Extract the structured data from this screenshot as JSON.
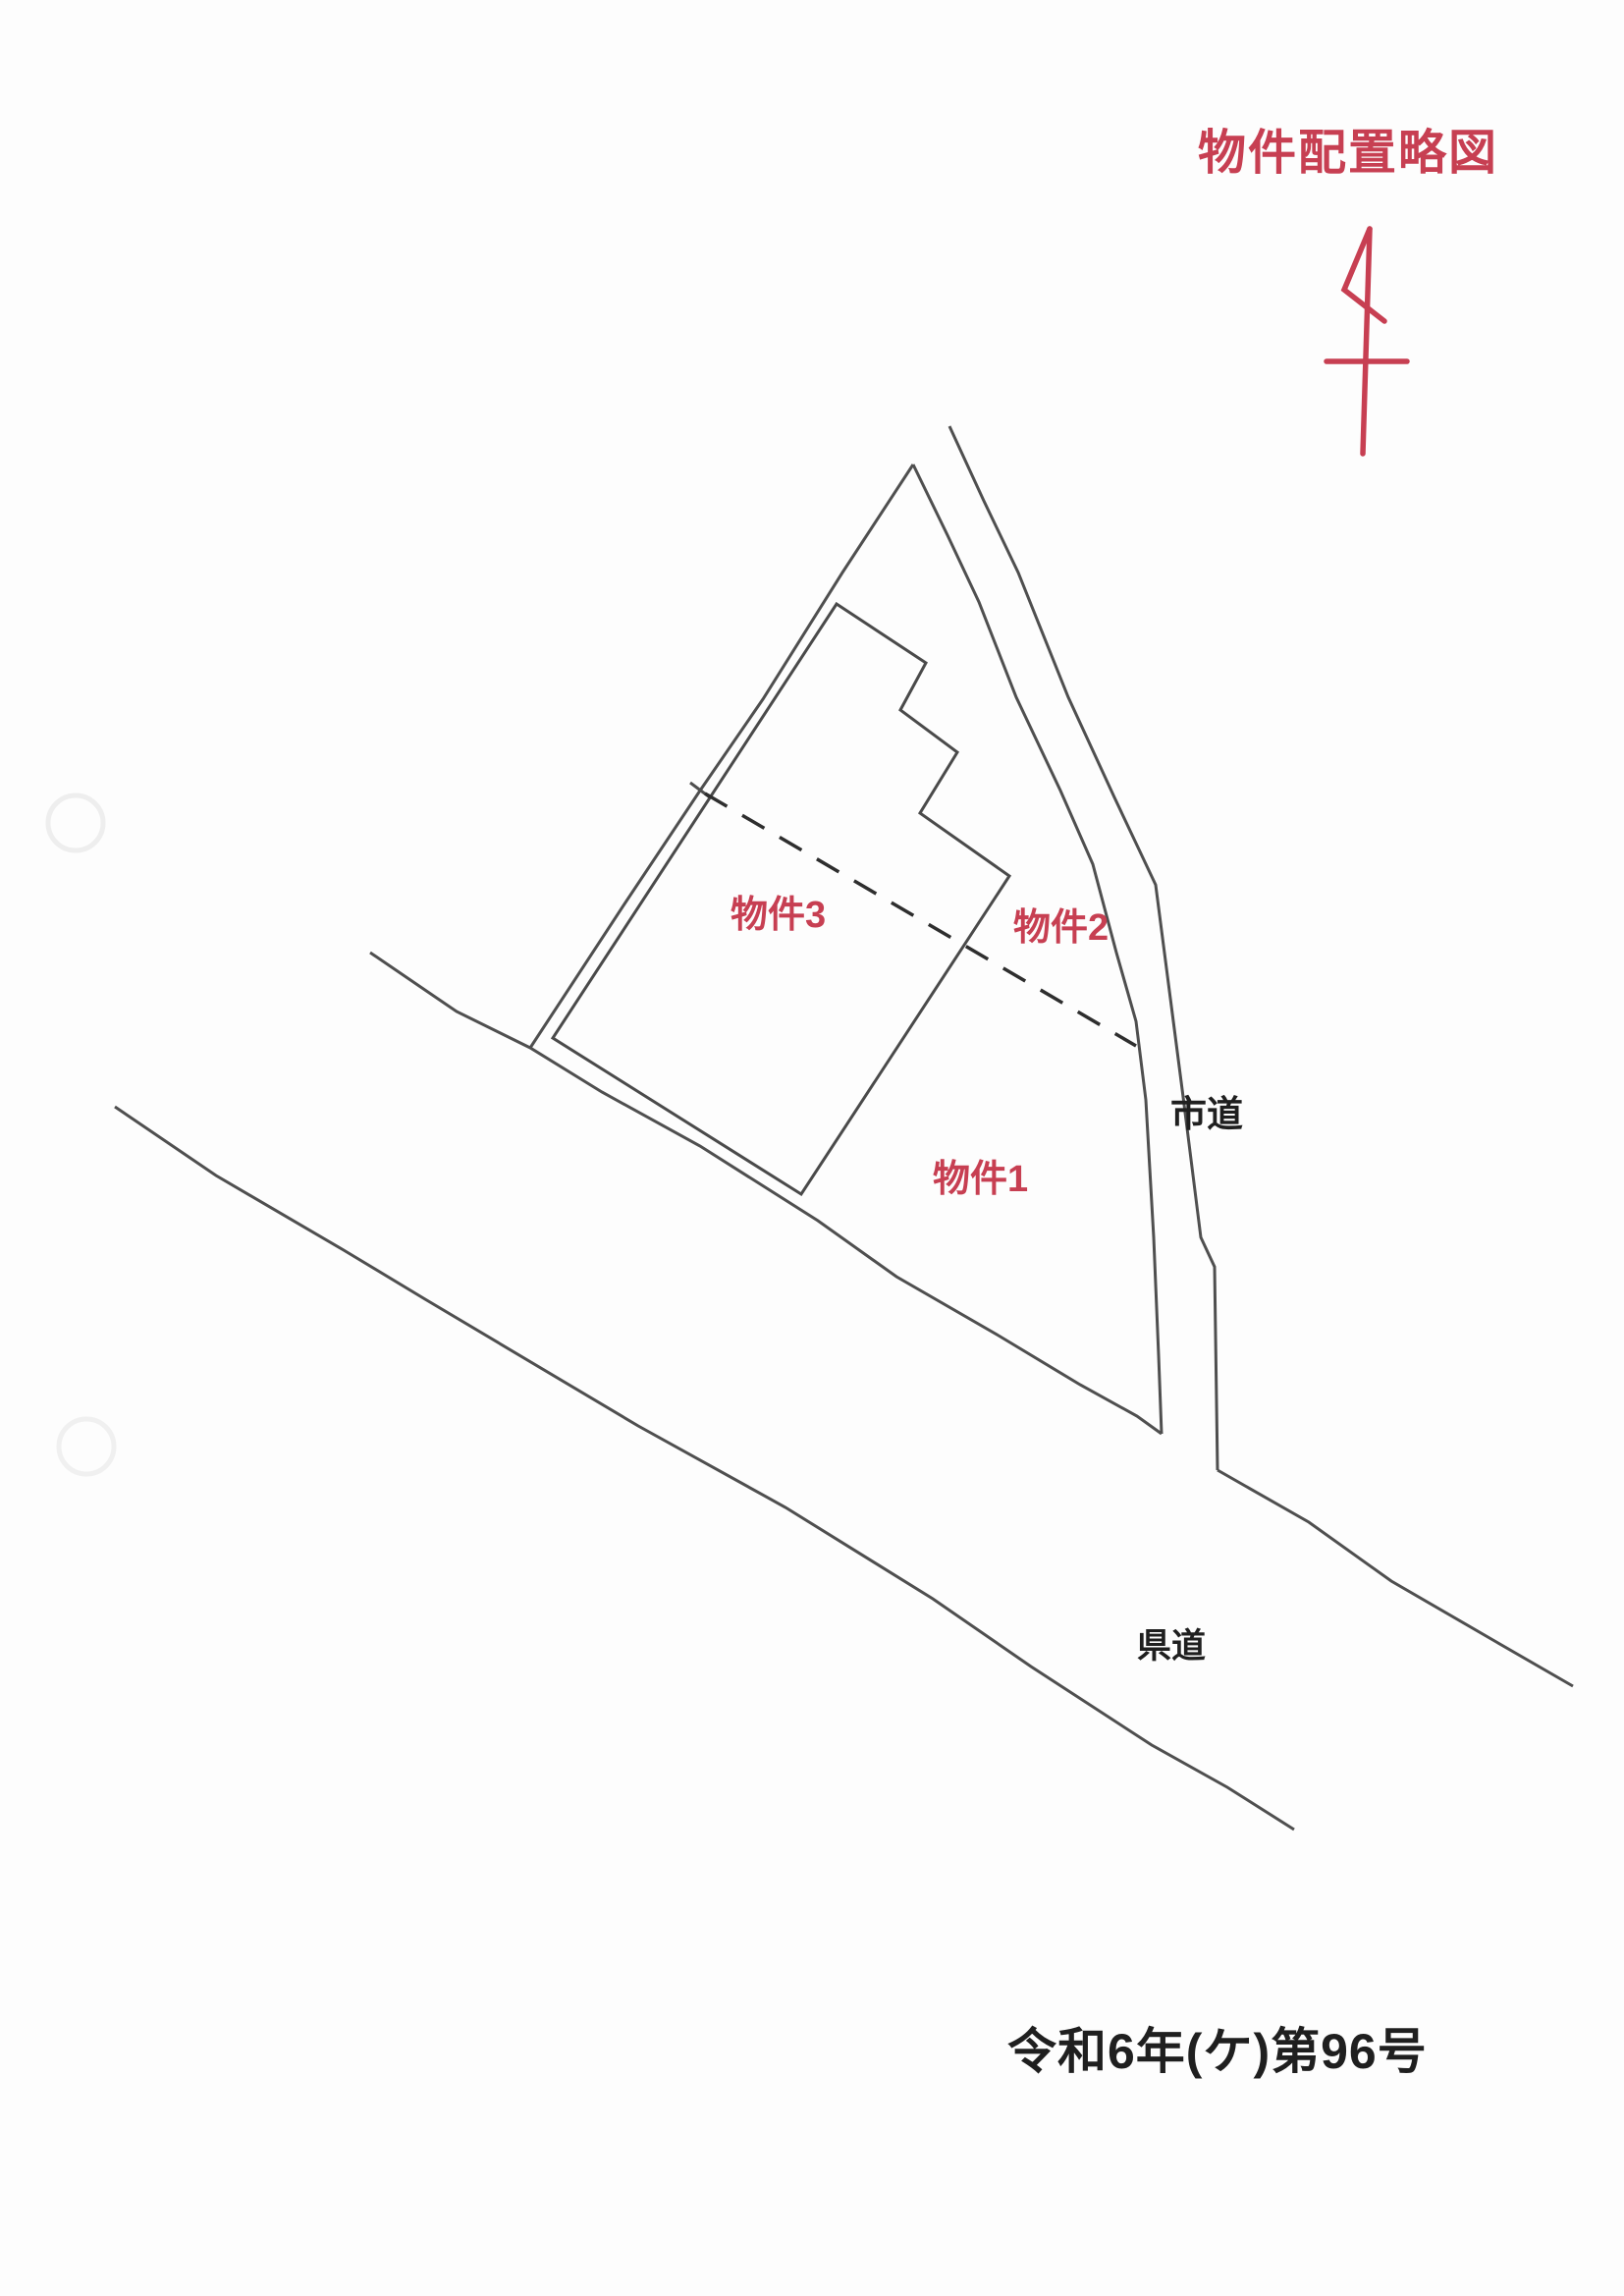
{
  "document": {
    "title": "物件配置略図",
    "case_number": "令和6年(ケ)第96号"
  },
  "map": {
    "parcel_labels": {
      "bukken3": "物件3",
      "bukken2": "物件2",
      "bukken1": "物件1"
    },
    "road_labels": {
      "city_road": "市道",
      "prefectural_road": "県道"
    },
    "icons": {
      "north_arrow": "north-arrow-icon"
    }
  },
  "colors": {
    "red_ink": "#c73f52",
    "black_ink": "#1f1f1f",
    "line_gray": "#4f4f4f",
    "paper": "#fdfdfd"
  }
}
